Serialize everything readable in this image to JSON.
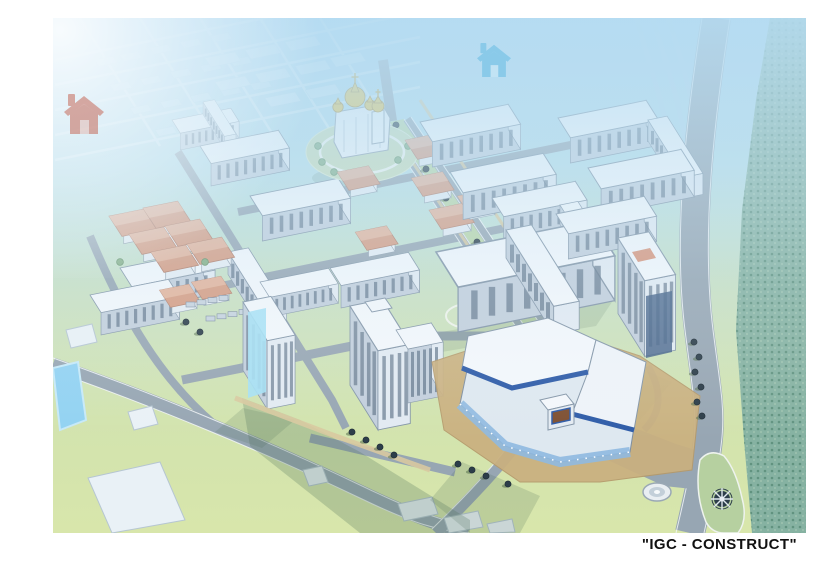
{
  "caption": {
    "text": "\"IGC - CONSTRUCT\"",
    "color": "#111111"
  },
  "watermarks": [
    {
      "name": "house-watermark-red",
      "color": "#c66a5a"
    },
    {
      "name": "house-watermark-blue",
      "color": "#7fc6e8"
    }
  ],
  "scene": {
    "type": "aerial-masterplan-rendering",
    "elements": [
      "orthodox-church",
      "central-boulevard",
      "apartment-blocks",
      "residential-towers",
      "shopping-center",
      "school",
      "kindergarten",
      "pond",
      "riverside-forest",
      "highway",
      "fountain",
      "compass-rose",
      "lawns",
      "tree-rows",
      "distant-city-grid"
    ]
  },
  "colors": {
    "sky_top": "#b3dcf1",
    "haze": "#cfe9f6",
    "grass": "#cfe2c2",
    "lawn": "#d6e6ae",
    "road": "#97a6b3",
    "facade_light": "#f3f7fb",
    "facade_shade": "#c3cfdc",
    "window": "#64788c",
    "glass_blue": "#a5e0f4",
    "roof_terracotta": "#d79d83",
    "dome_gold": "#e7c34e",
    "mall_blue": "#2f5ca8",
    "plaza_tan": "#cab07f",
    "pond_blue": "#92d2f2",
    "forest_green": "#86b2a2",
    "tree_dark": "#2c3d49",
    "sign_brown": "#7e5032"
  }
}
